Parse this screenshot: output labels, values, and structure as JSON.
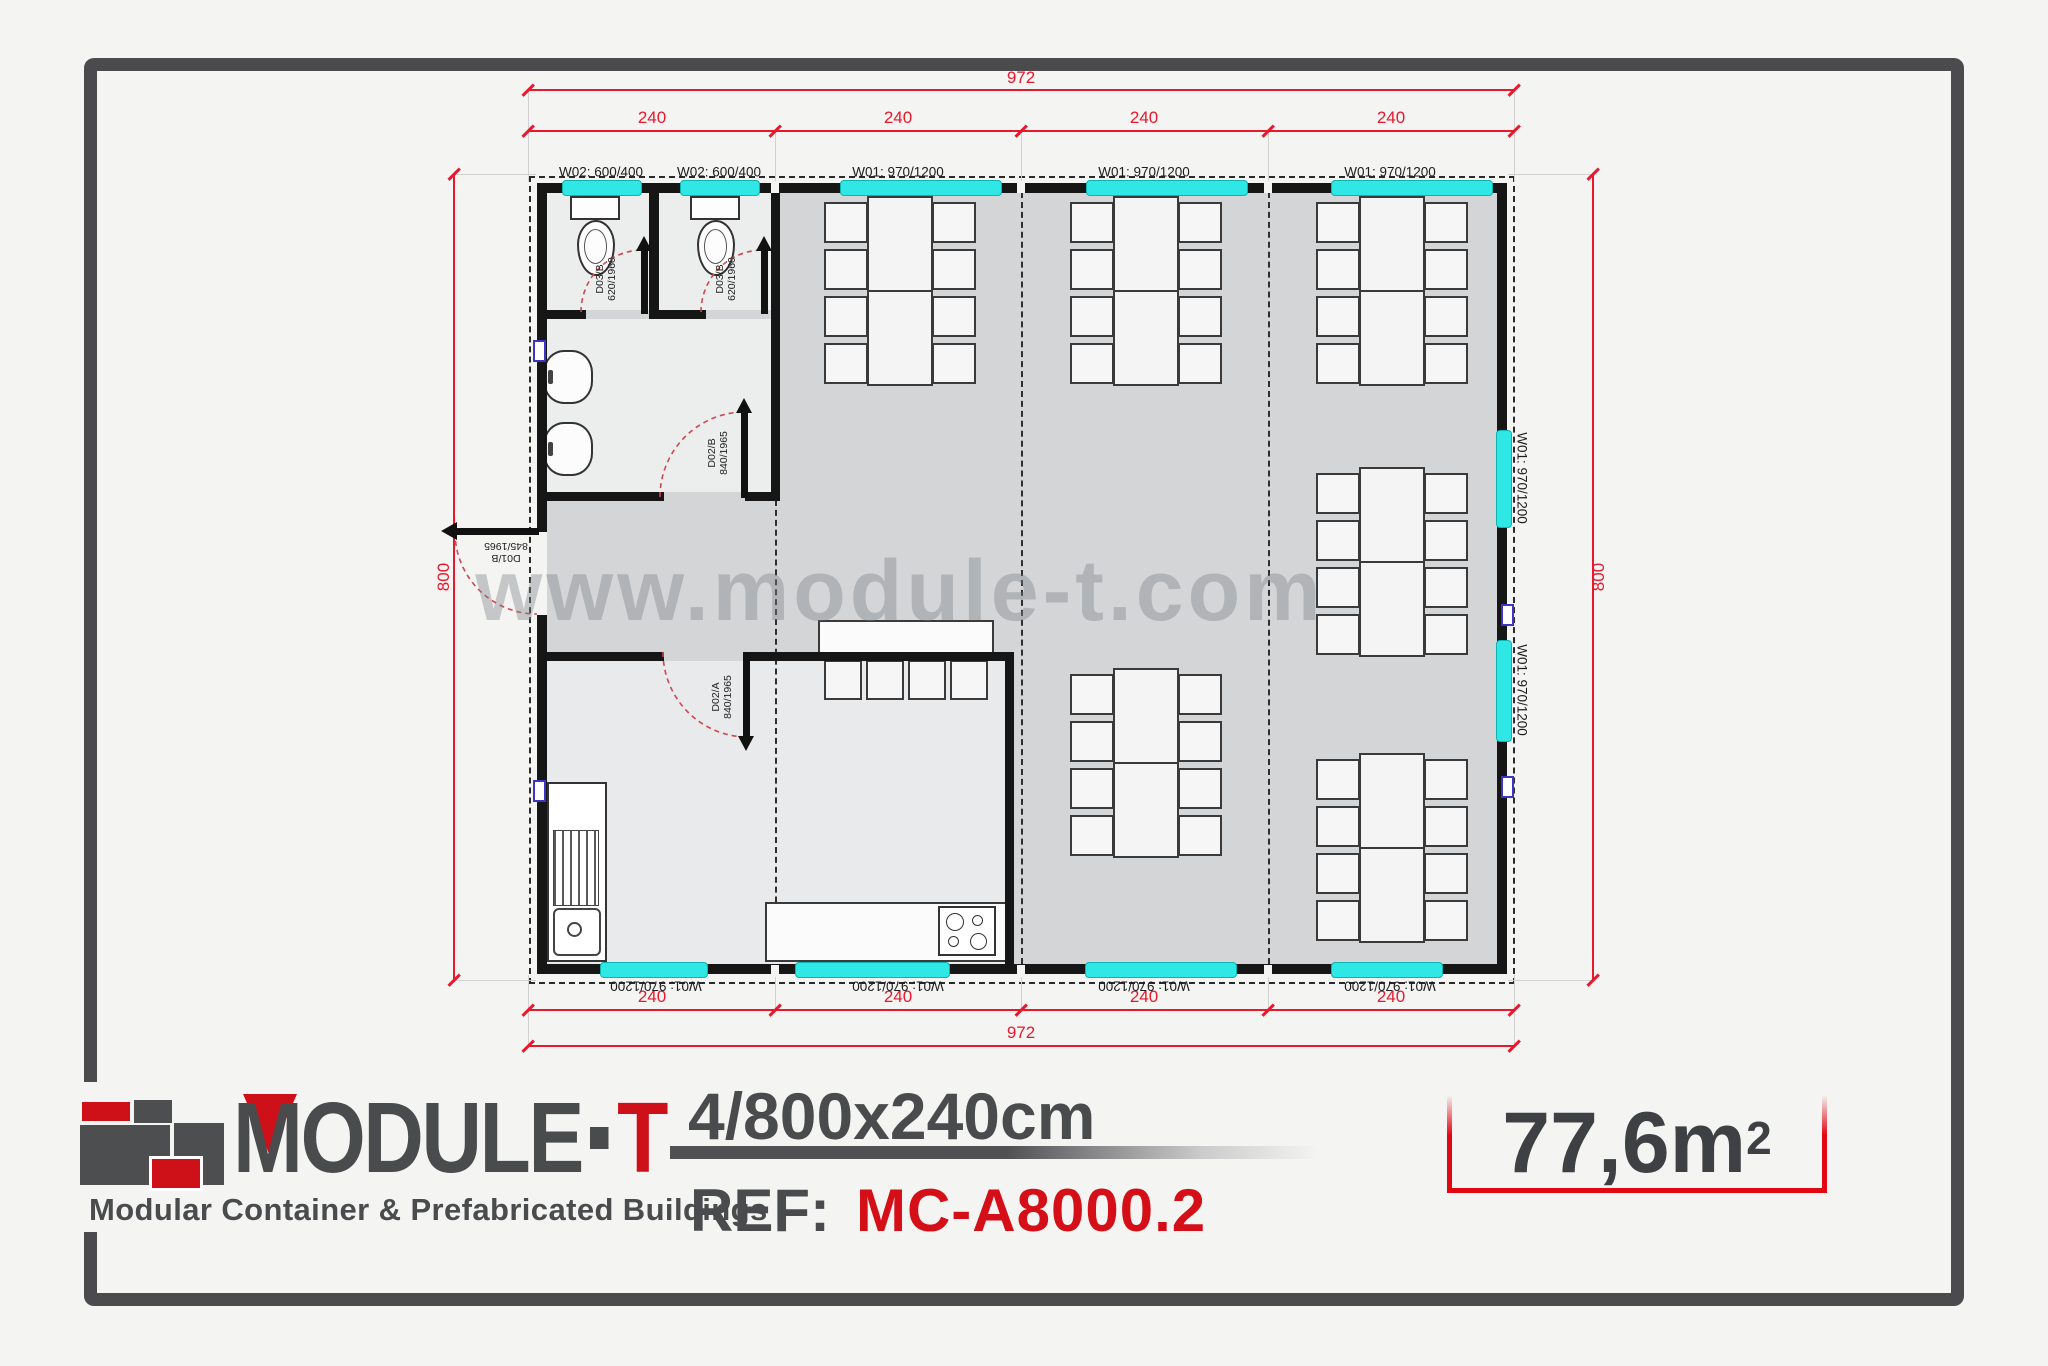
{
  "branding": {
    "wordmark_main": "MODULE",
    "wordmark_t": "T",
    "tagline": "Modular Container & Prefabricated Buildings"
  },
  "spec": {
    "size_label": "4/800x240cm",
    "ref_label": "REF:",
    "ref_value": "MC-A8000.2",
    "area_value": "77,6m",
    "area_exponent": "2"
  },
  "watermark": "www.module-t.com",
  "dimensions": {
    "top_total": "972",
    "bottom_total": "972",
    "top_segments": [
      "240",
      "240",
      "240",
      "240"
    ],
    "bottom_segments": [
      "240",
      "240",
      "240",
      "240"
    ],
    "left_total": "800",
    "right_total": "800"
  },
  "windows": {
    "top_labels": [
      "W02: 600/400",
      "W02: 600/400",
      "W01: 970/1200",
      "W01: 970/1200",
      "W01: 970/1200"
    ],
    "bottom_labels": [
      "W01: 970/1200",
      "W01: 970/1200",
      "W01: 970/1200",
      "W01: 970/1200"
    ],
    "right_labels": [
      "W01: 970/1200",
      "W01: 970/1200"
    ]
  },
  "doors": {
    "d03_1": {
      "line1": "D03/B",
      "line2": "620/1960"
    },
    "d03_2": {
      "line1": "D03/B",
      "line2": "620/1960"
    },
    "d02_b": {
      "line1": "D02/B",
      "line2": "840/1965"
    },
    "d02_a": {
      "line1": "D02/A",
      "line2": "840/1965"
    },
    "d01_b": {
      "line1": "D01/B",
      "line2": "845/1965"
    }
  }
}
